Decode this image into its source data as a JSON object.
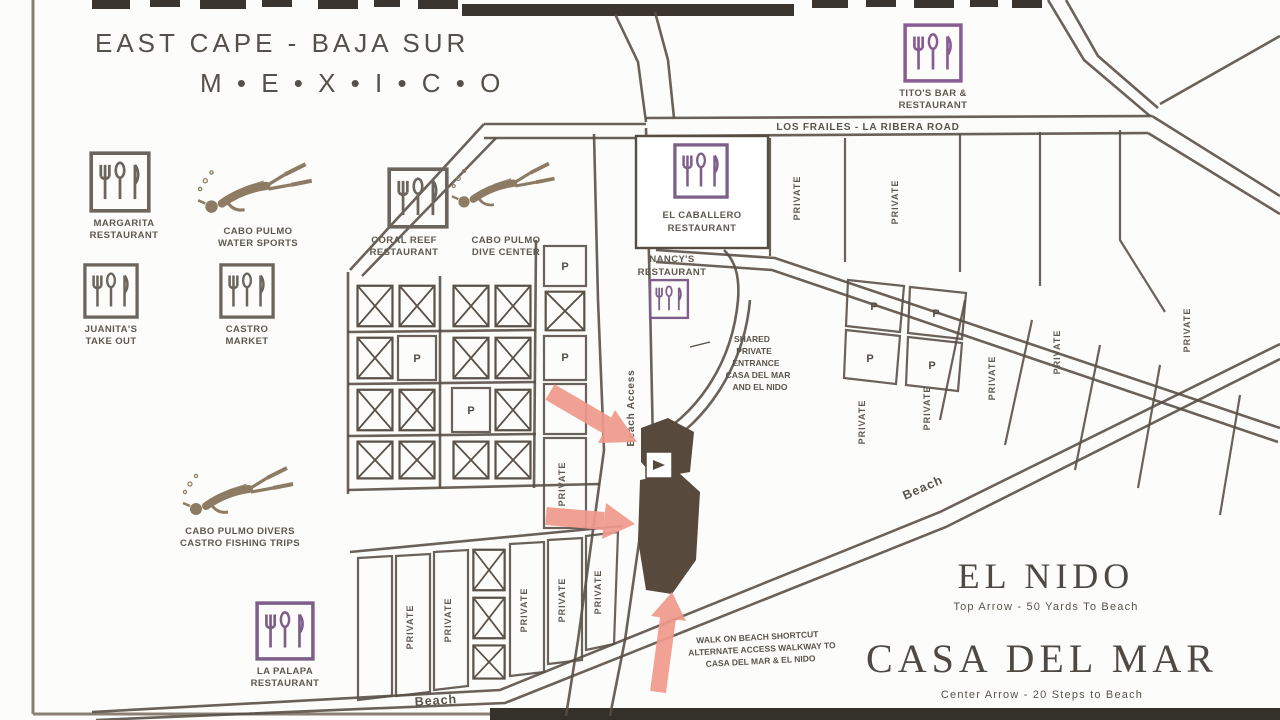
{
  "title": {
    "line1": "EAST CAPE - BAJA SUR",
    "line2": "M • E • X • I • C • O"
  },
  "roads": {
    "los_frailes_la_ribera": "LOS FRAILES - LA RIBERA ROAD",
    "beach_access": "Beach Access",
    "beach_right": "Beach",
    "beach_bottom": "Beach"
  },
  "lots": {
    "private": "PRIVATE",
    "p": "P"
  },
  "pois": {
    "margarita": {
      "line1": "MARGARITA",
      "line2": "RESTAURANT"
    },
    "juanitas": {
      "line1": "JUANITA'S",
      "line2": "TAKE OUT"
    },
    "castro_market": {
      "line1": "CASTRO",
      "line2": "MARKET"
    },
    "water_sports": {
      "line1": "CABO PULMO",
      "line2": "WATER SPORTS"
    },
    "coral_reef": {
      "line1": "CORAL REEF",
      "line2": "RESTAURANT"
    },
    "dive_center": {
      "line1": "CABO PULMO",
      "line2": "DIVE CENTER"
    },
    "el_caballero": {
      "line1": "EL CABALLERO",
      "line2": "RESTAURANT"
    },
    "nancys": {
      "line1": "NANCY'S",
      "line2": "RESTAURANT"
    },
    "titos": {
      "line1": "TITO'S BAR &",
      "line2": "RESTAURANT"
    },
    "fishing": {
      "line1": "CABO PULMO DIVERS",
      "line2": "CASTRO FISHING TRIPS"
    },
    "la_palapa": {
      "line1": "LA PALAPA",
      "line2": "RESTAURANT"
    }
  },
  "notes": {
    "driveway": {
      "line1": "SHARED",
      "line2": "PRIVATE",
      "line3": "ENTRANCE",
      "line4": "CASA DEL MAR",
      "line5": "AND EL NIDO"
    },
    "beach_walk": {
      "line1": "WALK ON BEACH SHORTCUT",
      "line2": "ALTERNATE ACCESS WALKWAY TO",
      "line3": "CASA DEL MAR & EL NIDO"
    }
  },
  "houses": {
    "el_nido": {
      "name": "EL NIDO",
      "subtitle": "Top Arrow - 50 Yards To Beach"
    },
    "casa_del_mar": {
      "name": "CASA DEL MAR",
      "subtitle": "Center Arrow - 20 Steps to Beach"
    }
  },
  "colors": {
    "ink": "#554c43",
    "arrow_pink": "#f09a8c",
    "building": "#57493c",
    "icon_gray": "#6b655e",
    "icon_purple": "#7d5f8a",
    "diver_tan": "#8d7b63"
  }
}
